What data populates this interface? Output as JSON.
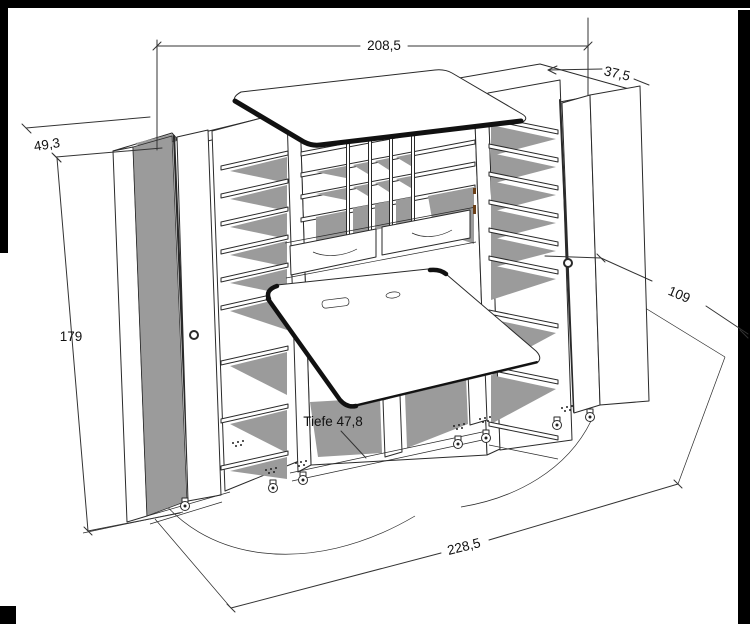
{
  "illustration": {
    "type": "furniture-technical-drawing",
    "subject": "Sewing cabinet with opened shelf doors, pigeonhole compartments, two drawers, fold-down work table, top table and casters, shown with dimension lines and door swing arcs",
    "colors": {
      "background": "#ffffff",
      "line": "#2a2a2a",
      "shadow": "#9b9b9b",
      "edge_band": "#111111",
      "frame_bar": "#000000",
      "accent_mark": "#6b3f17"
    }
  },
  "dimensions": {
    "width_top": {
      "label": "208,5"
    },
    "depth_top_right": {
      "label": "37,5"
    },
    "door_depth_left": {
      "label": "49,3"
    },
    "height_left": {
      "label": "179"
    },
    "depth_open_right": {
      "label": "109"
    },
    "table_depth": {
      "label": "Tiefe 47,8"
    },
    "width_floor": {
      "label": "228,5"
    }
  }
}
